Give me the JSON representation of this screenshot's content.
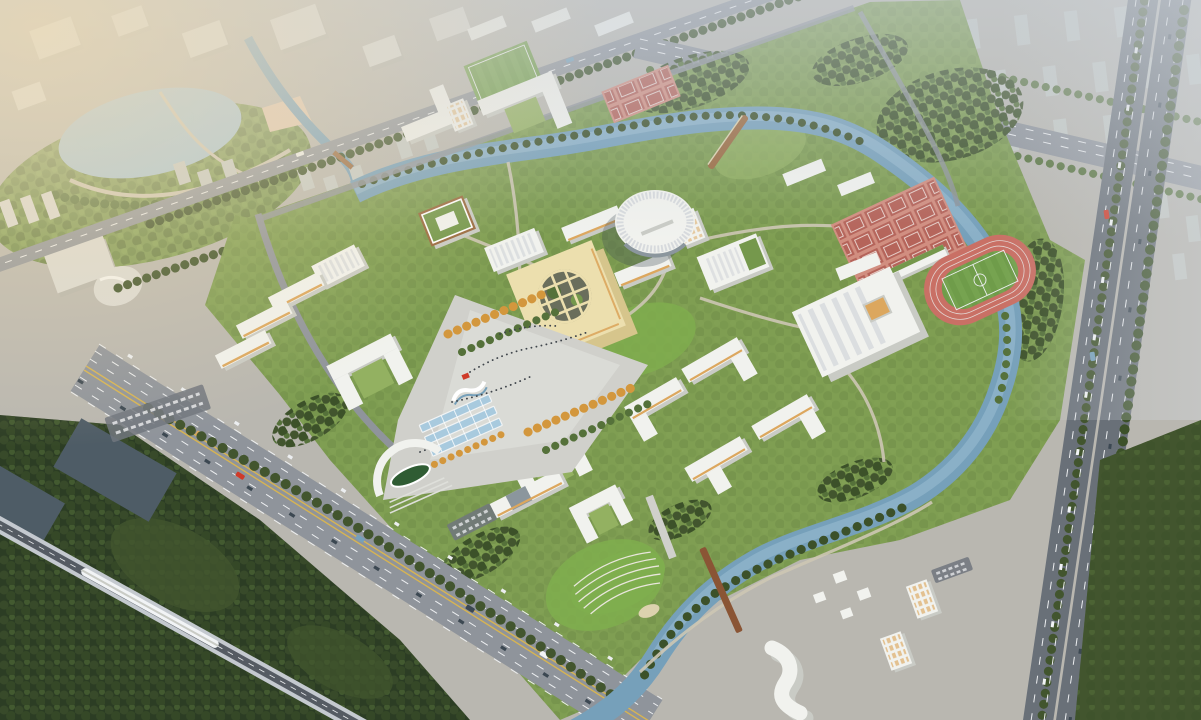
{
  "meta": {
    "alt_text": "Aerial bird's-eye architectural rendering of a university campus master plan surrounded by city blocks, a winding river, a tree-lined avenue, an elevated railway with a white train, and an expressway"
  },
  "scene": {
    "features": [
      "hazy city context blocks",
      "lake and waterfront park",
      "tree-lined boulevard",
      "eight-lane avenue with traffic",
      "elevated railway viaduct with white train",
      "expressway with median trees",
      "winding campus river with wooden bridges",
      "campus lawns and forest",
      "central plaza with crowds",
      "red sculpture",
      "white fountain",
      "blue solar canopies",
      "arched main gate with oval lawn",
      "cream courtyard cube main building",
      "round finned auditorium",
      "green-roof library",
      "gymnasium with skylight roof",
      "pink running track with soccer field",
      "grid of red sports courts",
      "grandstand",
      "dormitory cluster with practice field",
      "white academic slab buildings",
      "residential towers with lit windows",
      "s-curved white building",
      "dark riverside forest"
    ]
  },
  "palette": {
    "base": "#b9b7b0",
    "hazeA": "#cdd4dc",
    "warm": "#f0dcb4",
    "cityBlock": "#dadad5",
    "cityShade": "#b4b4ad",
    "apt": "#c6cbc7",
    "road": "#8f949b",
    "roadDark": "#70767e",
    "highway": "#697078",
    "laneW": "#eceef0",
    "laneY": "#d7b452",
    "railDeck": "#c4c9cf",
    "railDark": "#555b63",
    "train": "#f2f4f6",
    "grass": "#7f9e52",
    "grassLight": "#93b161",
    "lawn": "#7fae4e",
    "forest": "#42552e",
    "forestDark": "#2c3d24",
    "tree": "#55713a",
    "treeDark": "#3c5129",
    "treeOrange": "#d3973d",
    "treeYellow": "#c2b14a",
    "river": "#76a0ba",
    "riverLight": "#a3c4d6",
    "lake": "#a6c4d6",
    "canalDark": "#4e5c66",
    "plaza": "#d0d0cb",
    "plazaLight": "#dedfda",
    "path": "#cdc6b4",
    "bldg": "#f1f2ee",
    "bldgShade": "#c9cbc5",
    "bldgDark": "#aeb0ab",
    "warmFacade": "#dca75e",
    "glass": "#8b969d",
    "cream": "#ecdfae",
    "creamShade": "#d6c58c",
    "cubeCourt": "#6a6e5c",
    "ribs": "#d7dadd",
    "greenRoof": "#75984c",
    "trackPink": "#c97065",
    "trackLight": "#e3d4d0",
    "field": "#6f9c4a",
    "fieldLight": "#7da956",
    "courtBg": "#d18e80",
    "court": "#b5645a",
    "courtLine": "#ecd9d3",
    "solar": "#a8cade",
    "white": "#ffffff",
    "red": "#cf3a28",
    "wood": "#9a6a40",
    "corten": "#8a5535",
    "sand": "#dcd2ae",
    "crowd": "#3f454b",
    "parkGreen": "#7e9a55",
    "shadow": "#3c4852"
  }
}
